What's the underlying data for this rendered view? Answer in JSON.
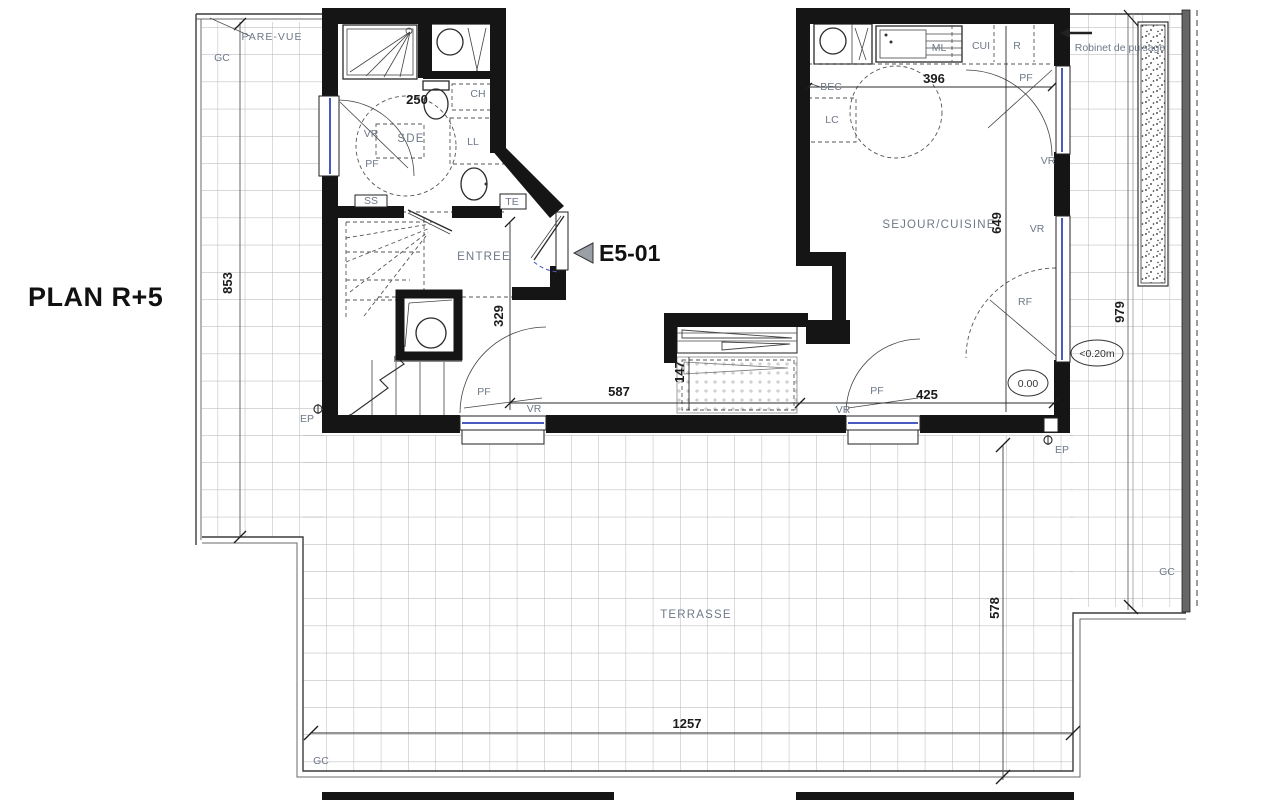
{
  "title": "PLAN R+5",
  "marker": {
    "code": "E5-01"
  },
  "rooms": {
    "entree": "ENTREE",
    "sejour_cuisine": "SEJOUR/CUISINE",
    "sde": "SDE",
    "terrasse": "TERRASSE"
  },
  "labels": {
    "pare_vue": "PARE-VUE",
    "gc": "GC",
    "ep": "EP",
    "vr": "VR",
    "pf": "PF",
    "rf": "RF",
    "ch": "CH",
    "ll": "LL",
    "ss": "SS",
    "te": "TE",
    "ml": "ML",
    "cui": "CUI",
    "r": "R",
    "bec": "BEC",
    "lc": "LC",
    "robinet_de_puisage": "Robinet de puisage"
  },
  "dimensions": {
    "bath_width": "250",
    "kitchen_width": "396",
    "living_height": "649",
    "hall_height": "329",
    "living_width_left": "587",
    "bay_height": "147",
    "living_width_right": "425",
    "terrace_right_height": "979",
    "terrace_left_height": "853",
    "terrace_bottom_height": "578",
    "terrace_width": "1257"
  },
  "levels": {
    "interior": "0.00",
    "terrace_offset": "<0.20m"
  },
  "colors": {
    "wall": "#151515",
    "grid_line": "#b0b0b0",
    "annotation": "#6e7889",
    "dimension": "#1c1c1c",
    "glazing_blue": "#4a5bbf",
    "marker_gray": "#9aa0a6"
  }
}
